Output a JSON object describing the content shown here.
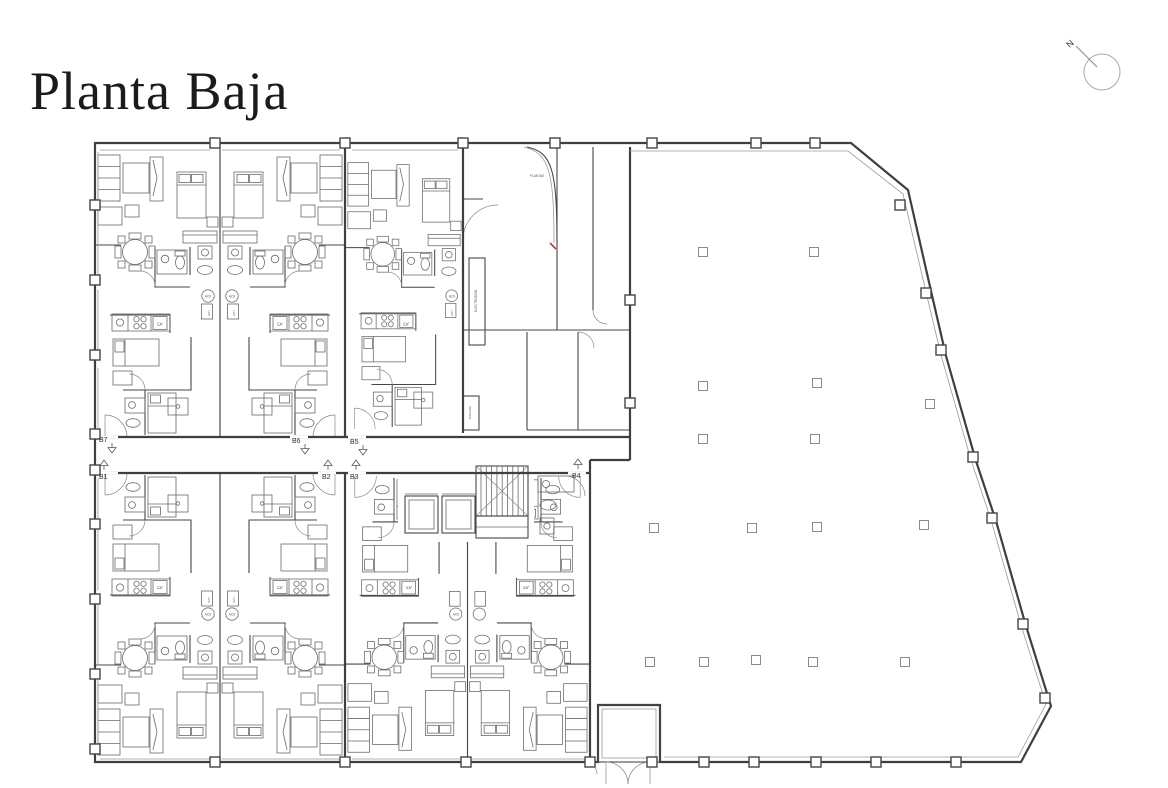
{
  "page": {
    "title": "Planta Baja"
  },
  "compass": {
    "north_label": "N"
  },
  "units": {
    "b1": "B1",
    "b2": "B2",
    "b3": "B3",
    "b4": "B4",
    "b5": "B5",
    "b6": "B6",
    "b7": "B7"
  },
  "annotations": {
    "stair_room": "PLANTAS",
    "utilities_shaft": "ELECTRODOM",
    "telecom_shaft": "TELECOM",
    "dishwasher": "LV",
    "water_heater": "ACS",
    "washer": "LVD"
  },
  "colors": {
    "ink": "#3f3f3f",
    "furniture": "#6a6a6a",
    "light": "#9a9a9a",
    "accent_red": "#c03030",
    "background": "#ffffff"
  }
}
